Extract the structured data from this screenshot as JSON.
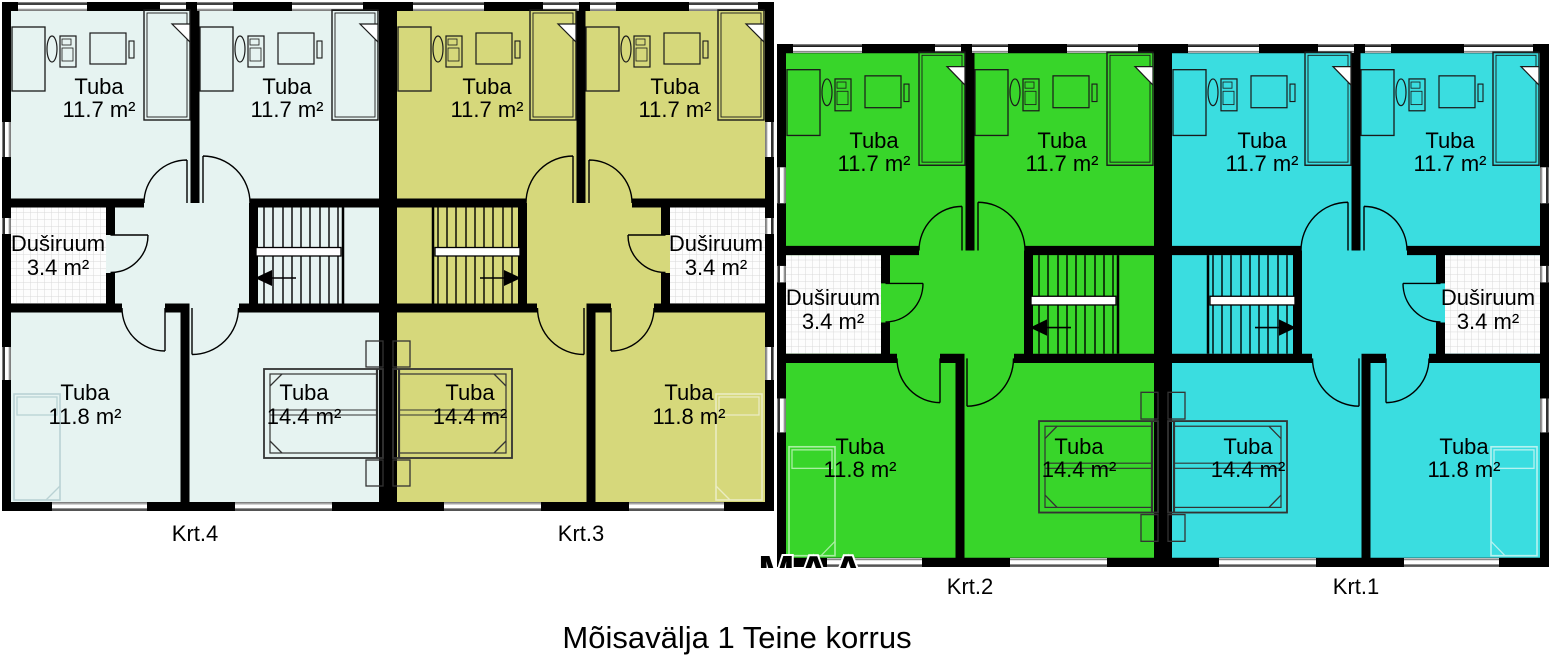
{
  "title": "Mõisavälja 1 Teine korrus",
  "watermark": "MAA",
  "apartments": [
    {
      "label": "Krt.4",
      "color": "#e6f3f1",
      "faint": "#b9d2d4",
      "rooms": [
        {
          "name": "Tuba",
          "area": "11.7 m²"
        },
        {
          "name": "Tuba",
          "area": "11.7 m²"
        },
        {
          "name": "Duširuum",
          "area": "3.4 m²"
        },
        {
          "name": "Tuba",
          "area": "11.8 m²"
        },
        {
          "name": "Tuba",
          "area": "14.4 m²"
        }
      ]
    },
    {
      "label": "Krt.3",
      "color": "#d6d87b",
      "faint": "#eaecc2",
      "rooms": [
        {
          "name": "Tuba",
          "area": "11.7 m²"
        },
        {
          "name": "Tuba",
          "area": "11.7 m²"
        },
        {
          "name": "Duširuum",
          "area": "3.4 m²"
        },
        {
          "name": "Tuba",
          "area": "14.4 m²"
        },
        {
          "name": "Tuba",
          "area": "11.8 m²"
        }
      ]
    },
    {
      "label": "Krt.2",
      "color": "#38d52a",
      "faint": "#a9efa2",
      "rooms": [
        {
          "name": "Tuba",
          "area": "11.7 m²"
        },
        {
          "name": "Tuba",
          "area": "11.7 m²"
        },
        {
          "name": "Duširuum",
          "area": "3.4 m²"
        },
        {
          "name": "Tuba",
          "area": "11.8 m²"
        },
        {
          "name": "Tuba",
          "area": "14.4 m²"
        }
      ]
    },
    {
      "label": "Krt.1",
      "color": "#3adde0",
      "faint": "#b6f2f0",
      "rooms": [
        {
          "name": "Tuba",
          "area": "11.7 m²"
        },
        {
          "name": "Tuba",
          "area": "11.7 m²"
        },
        {
          "name": "Duširuum",
          "area": "3.4 m²"
        },
        {
          "name": "Tuba",
          "area": "14.4 m²"
        },
        {
          "name": "Tuba",
          "area": "11.8 m²"
        }
      ]
    }
  ]
}
